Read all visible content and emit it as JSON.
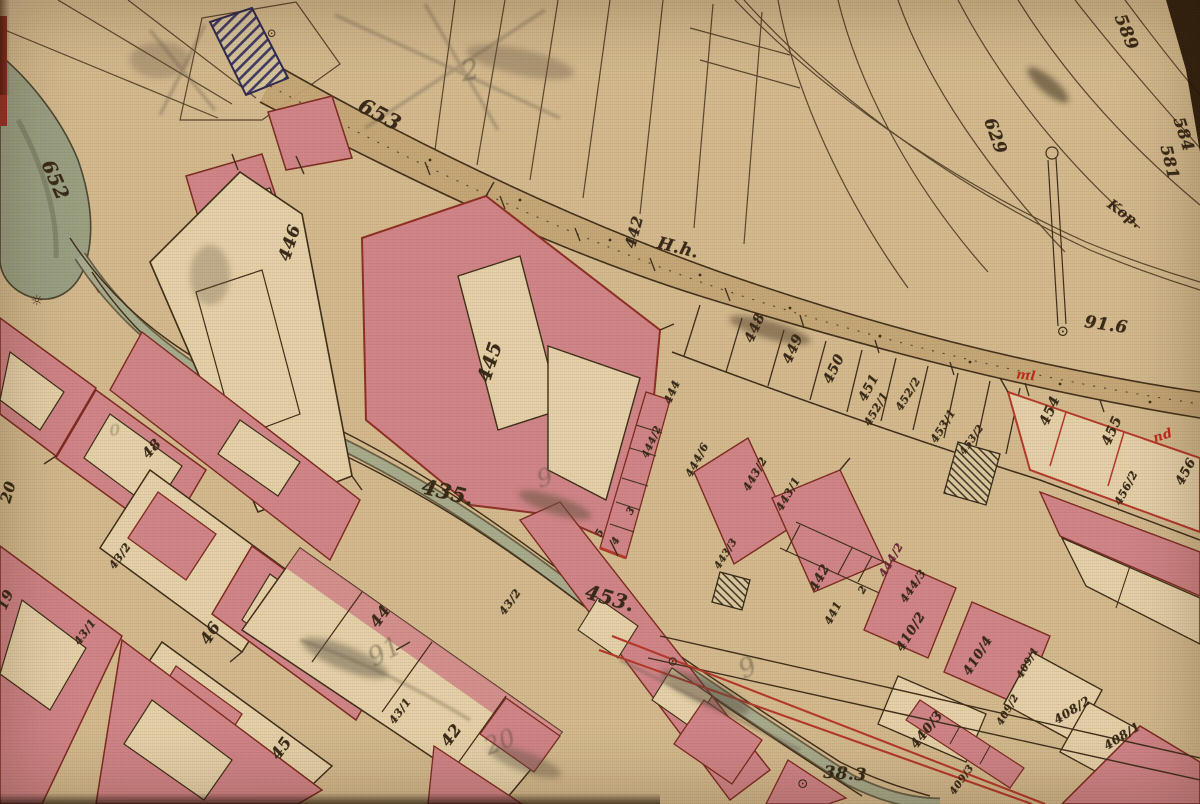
{
  "map": {
    "type": "Historical hand-drawn cadastral map (scanned sheet)",
    "paper_color": "#d5bb90",
    "building_fill": "#d2858a",
    "water_fill": "#a8ad8f",
    "road_fill": "#c5a678",
    "ink_color": "#3e2d1a",
    "red_ink_color": "#b5392b"
  },
  "labels": {
    "l652": {
      "text": "652"
    },
    "l653": {
      "text": "653"
    },
    "l589": {
      "text": "589"
    },
    "l629": {
      "text": "629"
    },
    "l584": {
      "text": "584"
    },
    "l581": {
      "text": "581"
    },
    "lkop": {
      "text": "Kop."
    },
    "l442a": {
      "text": "442"
    },
    "lhh": {
      "text": "H.h."
    },
    "l446": {
      "text": "446"
    },
    "l445": {
      "text": "445"
    },
    "l448": {
      "text": "448"
    },
    "l449": {
      "text": "449"
    },
    "l450": {
      "text": "450"
    },
    "l451": {
      "text": "451"
    },
    "l452_1": {
      "text": "452/1"
    },
    "l452_2": {
      "text": "452/2"
    },
    "l453_1": {
      "text": "453/1"
    },
    "l453_2": {
      "text": "453/2"
    },
    "l916": {
      "text": "91.6"
    },
    "l454": {
      "text": "454"
    },
    "l455": {
      "text": "455"
    },
    "l456_2": {
      "text": "456/2"
    },
    "l456": {
      "text": "456"
    },
    "l435": {
      "text": "435."
    },
    "l453b": {
      "text": "453."
    },
    "l20": {
      "text": "20"
    },
    "l19": {
      "text": "19"
    },
    "l48": {
      "text": "48"
    },
    "l43_2a": {
      "text": "43/2"
    },
    "l43_1a": {
      "text": "43/1"
    },
    "l46": {
      "text": "46"
    },
    "l45": {
      "text": "45"
    },
    "l44": {
      "text": "44"
    },
    "l43_1b": {
      "text": "43/1"
    },
    "l42": {
      "text": "42"
    },
    "l43_2b": {
      "text": "43/2"
    },
    "l444": {
      "text": "444"
    },
    "l444_2a": {
      "text": "444/2"
    },
    "c3": {
      "text": "3"
    },
    "c4": {
      "text": "4"
    },
    "c5": {
      "text": "5"
    },
    "l444_6": {
      "text": "444/6"
    },
    "l443_2": {
      "text": "443/2"
    },
    "l443_1": {
      "text": "443/1"
    },
    "l443_3": {
      "text": "443/3"
    },
    "l442b": {
      "text": "442"
    },
    "l441": {
      "text": "441"
    },
    "c2": {
      "text": "2"
    },
    "l444_2b": {
      "text": "444/2"
    },
    "l444_3": {
      "text": "444/3"
    },
    "l410_2": {
      "text": "410/2"
    },
    "l410_4": {
      "text": "410/4"
    },
    "l440_3": {
      "text": "440/3"
    },
    "l409_1": {
      "text": "409/1"
    },
    "l409_2": {
      "text": "409/2"
    },
    "l409_3": {
      "text": "409/3"
    },
    "l408_2": {
      "text": "408/2"
    },
    "l408_1": {
      "text": "408/1"
    },
    "l383": {
      "text": "38.3"
    }
  },
  "red_annotations": {
    "ml": {
      "text": "ml"
    },
    "nd": {
      "text": "nd"
    }
  },
  "pencil_marks": {
    "m91": {
      "text": "91"
    },
    "m20": {
      "text": "20"
    },
    "m9a": {
      "text": "9"
    },
    "m9b": {
      "text": "9"
    },
    "m2": {
      "text": "2"
    },
    "m0": {
      "text": "0"
    }
  },
  "symbols": {
    "circle_a": {
      "text": "⊙"
    },
    "circle_b": {
      "text": "⊙"
    },
    "circle_c": {
      "text": "⊙"
    },
    "circle_d": {
      "text": "⊙"
    },
    "sun": {
      "text": "☼"
    }
  }
}
